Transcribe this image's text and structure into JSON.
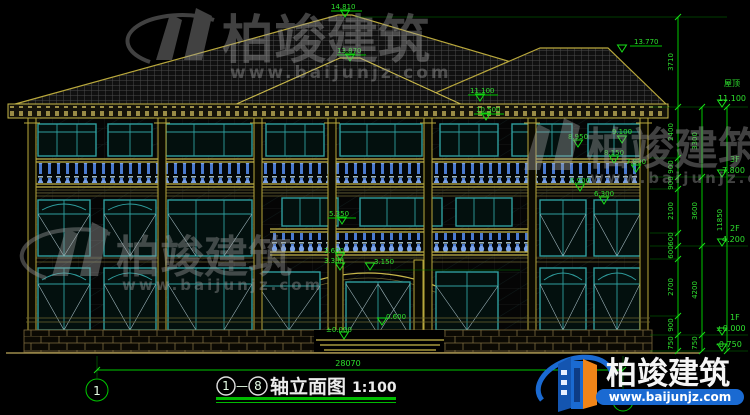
{
  "drawing": {
    "title_text": "轴立面图",
    "scale": "1:100",
    "axis_start": "1",
    "axis_end": "8",
    "axis_dash": "—",
    "total_width_dim": "28070",
    "total_height_dim": "11850"
  },
  "levels": [
    {
      "name": "屋顶",
      "elev": "11.100"
    },
    {
      "name": "3F",
      "elev": "7.800"
    },
    {
      "name": "2F",
      "elev": "4.200"
    },
    {
      "name": "1F",
      "elev": "±0.000"
    },
    {
      "name": "",
      "elev": "-0.750"
    }
  ],
  "dim_chain_inner": [
    "3710",
    "2400",
    "900",
    "900",
    "2100",
    "600",
    "600",
    "2700",
    "900",
    "750"
  ],
  "dim_chain_mid": [
    "3300",
    "3600",
    "4200",
    "750"
  ],
  "spot_elevations": {
    "ridge_main": "14.810",
    "ridge_front": "13.870",
    "ridge_right": "13.770",
    "eave": "11.100",
    "win3f_top": "10.500",
    "cornice3f": "9.100",
    "rail3f": "8.950",
    "band3f": "8.150",
    "floor3": "7.800",
    "win2f_top": "6.900",
    "balcony2f": "6.300",
    "mid2f": "5.350",
    "porch_top": "3.600",
    "porch_band": "3.300",
    "canopy": "3.150",
    "sill1f": "0.600",
    "ground": "±0.000"
  },
  "watermark": {
    "brand": "柏竣建筑",
    "site": "www.baijunjz.com"
  },
  "colors": {
    "dim_green": "#00c800",
    "line_yellow": "#b9a83c",
    "frame_teal": "#2f9e9e",
    "baluster_blue": "#4a7ad0",
    "brand_blue": "#1a6ad2",
    "brand_orange": "#f08418"
  }
}
